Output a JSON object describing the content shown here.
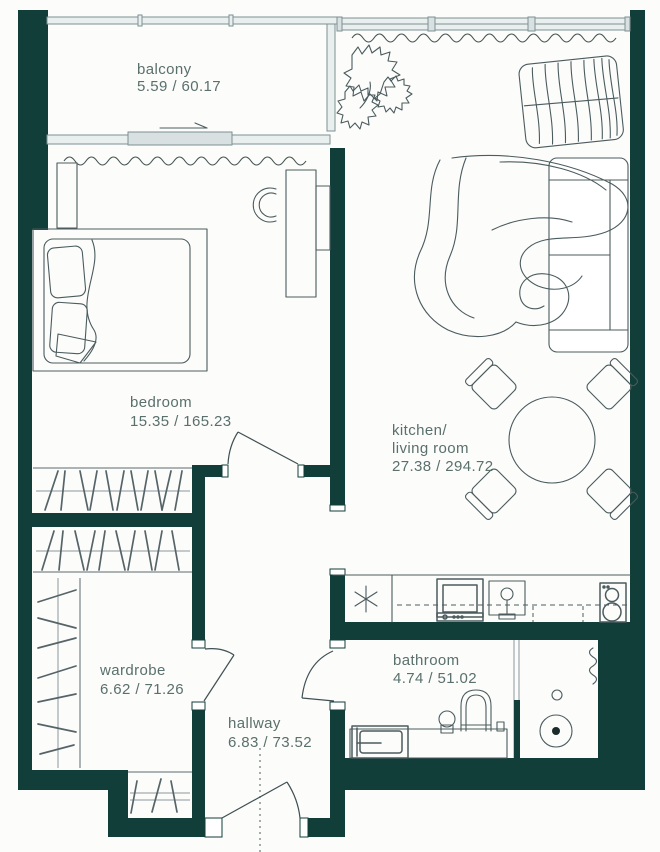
{
  "plan": {
    "type": "apartment-floor-plan",
    "rooms": {
      "balcony": {
        "name": "balcony",
        "area": "5.59 / 60.17"
      },
      "bedroom": {
        "name": "bedroom",
        "area": "15.35 / 165.23"
      },
      "kitchen_living": {
        "line1": "kitchen/",
        "line2": "living room",
        "area": "27.38 / 294.72"
      },
      "wardrobe": {
        "name": "wardrobe",
        "area": "6.62 / 71.26"
      },
      "hallway": {
        "name": "hallway",
        "area": "6.83 / 73.52"
      },
      "bathroom": {
        "name": "bathroom",
        "area": "4.74 / 51.02"
      }
    },
    "colors": {
      "wall": "#123e3a",
      "glass": "#e9eeee",
      "line": "#4b5b5e",
      "text": "#5a706c",
      "background": "#fcfcfb"
    },
    "furniture_icons": [
      "bed-icon",
      "pillow-icon",
      "wardrobe-cabinet-icon",
      "desk-icon",
      "desk-chair-icon",
      "plant-icon",
      "cushion-pile-icon",
      "sofa-icon",
      "rug-icon",
      "dining-table-icon",
      "dining-chair-icon",
      "hob-burner-icon",
      "oven-icon",
      "kitchen-sink-icon",
      "cooktop-icon",
      "washing-machine-icon",
      "bathroom-sink-icon",
      "toilet-icon",
      "shower-drain-icon",
      "towel-radiator-icon",
      "clothes-hanger-icon",
      "door-swing-icon",
      "sliding-door-arrow-icon",
      "curtain-icon"
    ]
  }
}
